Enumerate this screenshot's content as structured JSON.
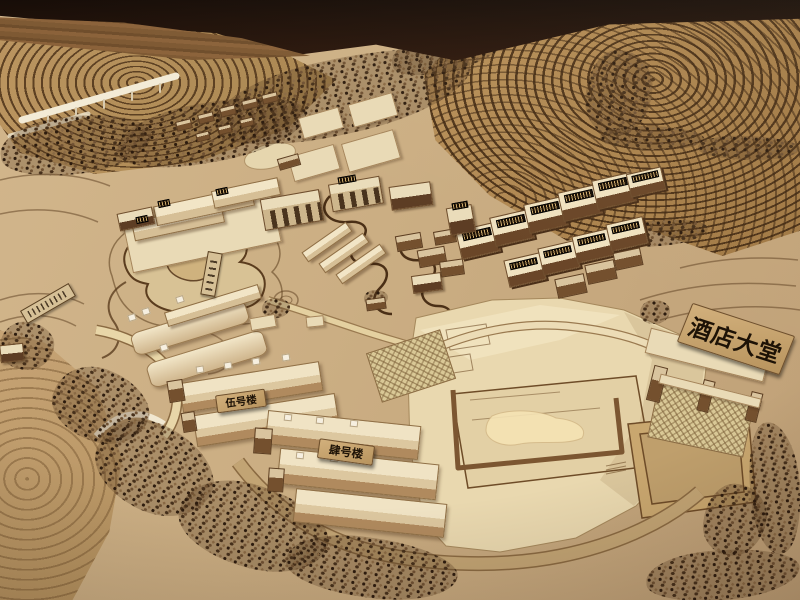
{
  "scene": {
    "description": "Photograph of a wooden architectural scale model of a hillside resort: terraced fields, rows of model trees, clusters of wooden buildings, a contoured pond, long dormitory blocks and a large pale hotel-lobby plaza with a gateway sign.",
    "signs": {
      "hotel_lobby": "酒店大堂",
      "building_no5": "伍号楼",
      "building_no4": "肆号楼"
    },
    "colors": {
      "background_dark": "#201009",
      "wood_floor": "#7a5531",
      "model_base": "#cbae83",
      "terrace_dark": "#6a4423",
      "plaza_light": "#ecdcb4",
      "tree_dark": "#34220f",
      "sign_board": "#c8a872",
      "sign_text": "#1d1206"
    }
  }
}
